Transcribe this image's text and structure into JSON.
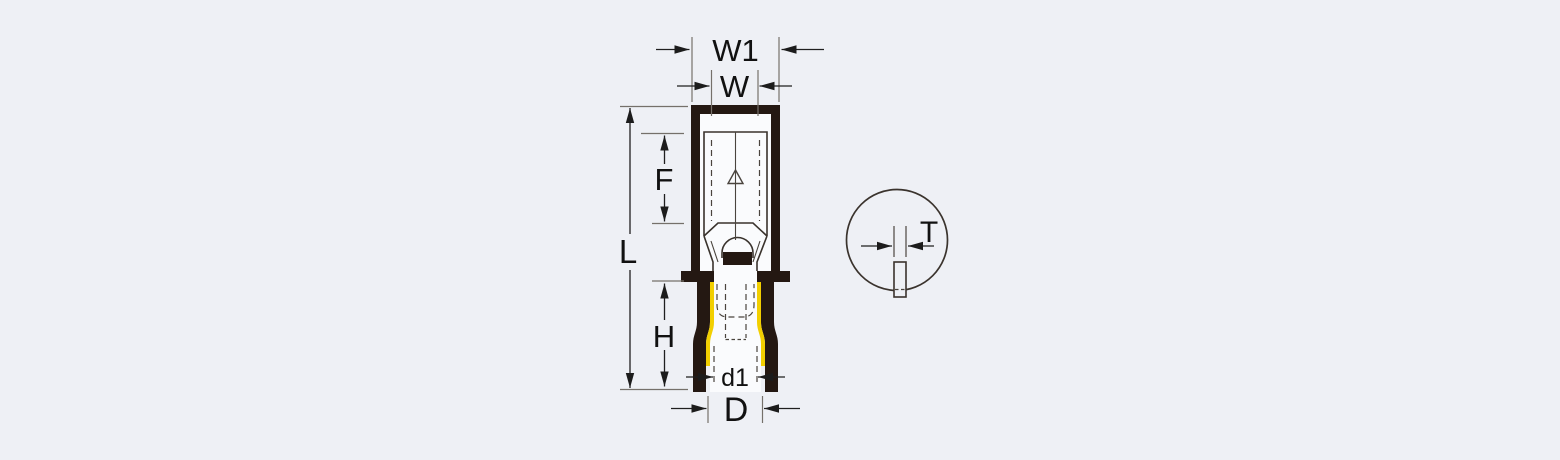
{
  "labels": {
    "W1": "W1",
    "W": "W",
    "F": "F",
    "L": "L",
    "H": "H",
    "d1": "d1",
    "D": "D",
    "T": "T"
  },
  "colors": {
    "background": "#eef0f5",
    "body": "#241812",
    "stripe": "#f2cf00",
    "line": "#3a332d",
    "dimension": "#1f1f1f",
    "text": "#111111"
  }
}
